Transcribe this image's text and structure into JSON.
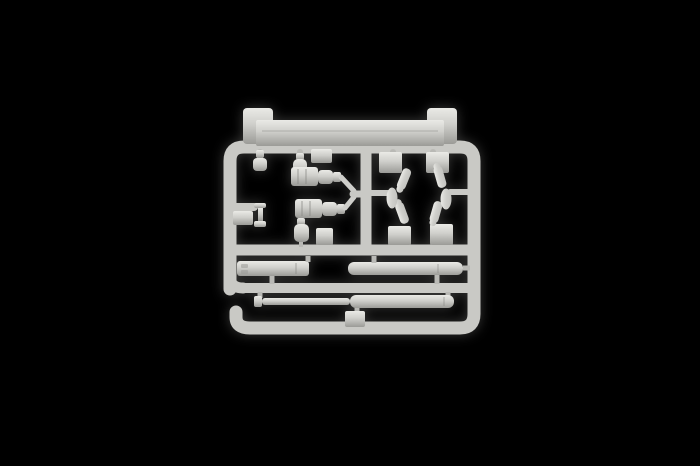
{
  "image": {
    "type": "product-photograph",
    "subject": "plastic model kit sprue (injection-moulded parts frame)",
    "description": "A single light-grey polystyrene sprue with model kit parts attached, photographed centred on a plain black background. No text, labels or watermarks are visible.",
    "background_color": "#000000"
  },
  "palette": {
    "plastic_highlight": "#eaeae6",
    "plastic_light": "#dcdcd8",
    "plastic_base": "#cfcfcb",
    "plastic_mid": "#c3c3bf",
    "runner": "#c9c9c5",
    "runner_dark": "#b9b9b5",
    "plastic_shadow": "#9b9b97",
    "detail_shadow": "#878783"
  },
  "sprue": {
    "frame": {
      "shape": "rounded rectangle runner frame",
      "detail": "lower-left corner of the outer bottom rail ends in an upward J-hook; one mid horizontal runner, one lower horizontal runner and one central vertical runner divide the frame"
    },
    "parts": [
      {
        "name": "flat-top-bar",
        "description": "long flat bar with a raised rectangular tab at each end",
        "position": "along the top rail, outside the frame"
      },
      {
        "name": "small-pin-fitting",
        "description": "tiny capped pin hanging from the top rail",
        "position": "upper left"
      },
      {
        "name": "bottle-fitting-upper",
        "description": "small bottle-shaped fitting",
        "position": "above upper muzzle-brake"
      },
      {
        "name": "muzzle-brake-upper",
        "description": "grooved block with stepped cylinder, joined by a thin rod to a Y-junction on the central runner",
        "position": "centre-left, upper"
      },
      {
        "name": "muzzle-brake-lower",
        "description": "grooved block with stepped cylinder, joined by a thin rod to the same Y-junction",
        "position": "centre-left, lower"
      },
      {
        "name": "bottle-fitting-lower",
        "description": "small bottle-shaped fitting",
        "position": "below lower muzzle-brake"
      },
      {
        "name": "flanged-pin",
        "description": "small pin with flanged cap and base on a short side runner with pad",
        "position": "left edge, mid height"
      },
      {
        "name": "cross-cluster",
        "description": "four corner pads, four small angled cylindrical fittings and two oval fittings arranged around a cross-shaped opening",
        "position": "right section"
      },
      {
        "name": "rectangular-sleeve",
        "description": "flat rectangular sleeve part with two small embossed marks at its left end",
        "position": "lower left row"
      },
      {
        "name": "short-cylinder",
        "description": "short plain cylinder section",
        "position": "lower right row"
      },
      {
        "name": "long-gun-barrel",
        "description": "long two-step gun barrel: thin rod half and thicker cylinder half, with end cap",
        "position": "bottom row, spanning most of the frame width"
      },
      {
        "name": "mounting-pads",
        "description": "several small rectangular moulding pads attached to the runners",
        "position": "throughout"
      }
    ]
  }
}
